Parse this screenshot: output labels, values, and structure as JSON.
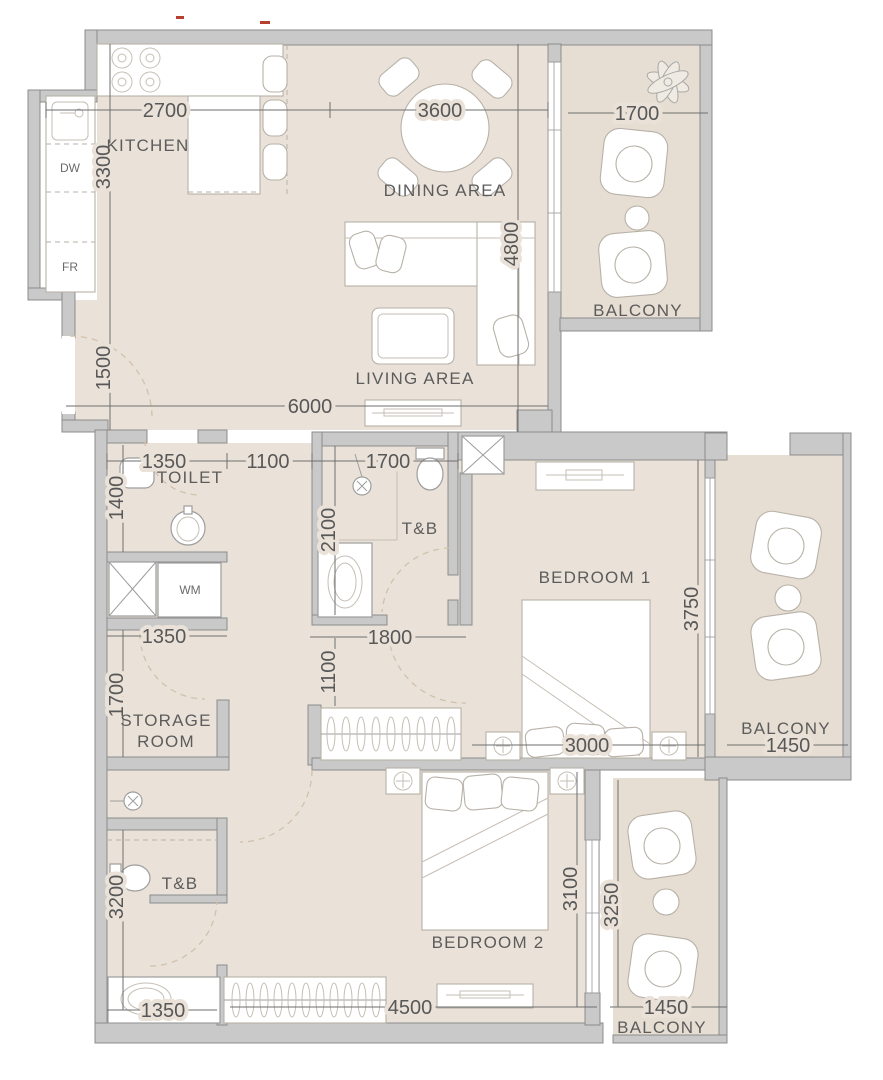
{
  "plan_type": "apartment-floor-plan",
  "colors": {
    "floor": "#eae2d8",
    "balcony_floor": "#e7ded3",
    "wall_fill": "#c9c9c9",
    "wall_stroke": "#8c8c8c",
    "dimension_text": "#585858",
    "artifact_red": "#b5402f"
  },
  "rooms": {
    "kitchen": "KITCHEN",
    "dining": "DINING AREA",
    "living": "LIVING AREA",
    "toilet": "TOILET",
    "tb_mid": "T&B",
    "bedroom1": "BEDROOM 1",
    "storage_line1": "STORAGE",
    "storage_line2": "ROOM",
    "tb_bottom": "T&B",
    "bedroom2": "BEDROOM 2",
    "balcony_top": "BALCONY",
    "balcony_right": "BALCONY",
    "balcony_bottom": "BALCONY"
  },
  "appliances": {
    "dw": "DW",
    "fr": "FR",
    "wm": "WM"
  },
  "dimensions": {
    "kitchen_width": "2700",
    "dining_width": "3600",
    "balcony_top_width": "1700",
    "kitchen_height": "3300",
    "living_height": "4800",
    "entry_height": "1500",
    "living_width": "6000",
    "toilet_width": "1350",
    "hall_width": "1100",
    "tb_width": "1700",
    "toilet_height": "1400",
    "tb_height": "2100",
    "bedroom1_height": "3750",
    "storage_width": "1350",
    "wardrobe_width": "1800",
    "wardrobe_height": "1100",
    "storage_height": "1700",
    "bedroom1_width": "3000",
    "balcony_right_width": "1450",
    "tb2_height": "3200",
    "bedroom2_height": "3100",
    "balcony_bottom_height": "3250",
    "vanity_width": "1350",
    "bedroom2_width": "4500",
    "balcony_bottom_width": "1450"
  }
}
